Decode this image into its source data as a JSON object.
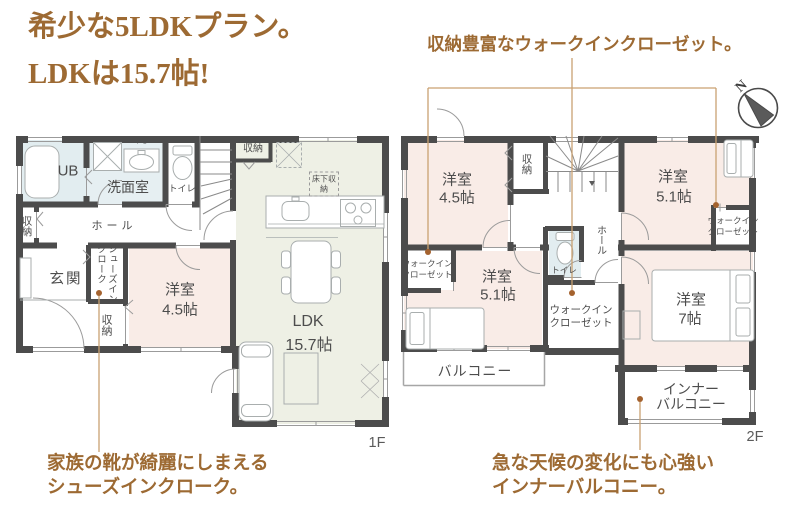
{
  "title": [
    "希少な5LDKプラン。",
    "LDKは15.7帖!"
  ],
  "callout_wic": "収納豊富なウォークインクローゼット。",
  "caption_shoes": [
    "家族の靴が綺麗にしまえる",
    "シューズインクローク。"
  ],
  "caption_inner_balcony": [
    "急な天候の変化にも心強い",
    "インナーバルコニー。"
  ],
  "compass": {
    "north_label": "N"
  },
  "floor1": {
    "floor_label": "1F",
    "rooms": {
      "ub": "UB",
      "washroom": "洗面室",
      "ps": "PS",
      "toilet": "トイレ",
      "closet_ldk": "収納",
      "closet_hall": "収納",
      "hall": "ホール",
      "genkan": "玄関",
      "shoes_in_cloak": "シューズインクローク",
      "closet_genkan": "収納",
      "yoshitsu": {
        "name": "洋室",
        "size": "4.5帖"
      },
      "ldk": {
        "name": "LDK",
        "size": "15.7帖"
      },
      "underfloor_storage": "床下収納"
    }
  },
  "floor2": {
    "floor_label": "2F",
    "rooms": {
      "yoshitsu_45": {
        "name": "洋室",
        "size": "4.5帖"
      },
      "closet": "収納",
      "yoshitsu_51_ne": {
        "name": "洋室",
        "size": "5.1帖"
      },
      "wic_ne": "ウォークインクローゼット",
      "hall": "ホール",
      "toilet": "トイレ",
      "wic_w": "ウォークインクローゼット",
      "yoshitsu_51_sw": {
        "name": "洋室",
        "size": "5.1帖"
      },
      "wic_center": "ウォークインクローゼット",
      "yoshitsu_7": {
        "name": "洋室",
        "size": "7帖"
      },
      "balcony": "バルコニー",
      "inner_balcony": [
        "インナー",
        "バルコニー"
      ]
    }
  },
  "colors": {
    "accent_brown": "#9d6a33",
    "connector_brown": "#c9a172",
    "dot_brown": "#a4622e",
    "wall": "#4c4c4c",
    "room_pink": "#f9ece7",
    "room_blue": "#e2edf0",
    "room_green": "#eef0e5"
  }
}
